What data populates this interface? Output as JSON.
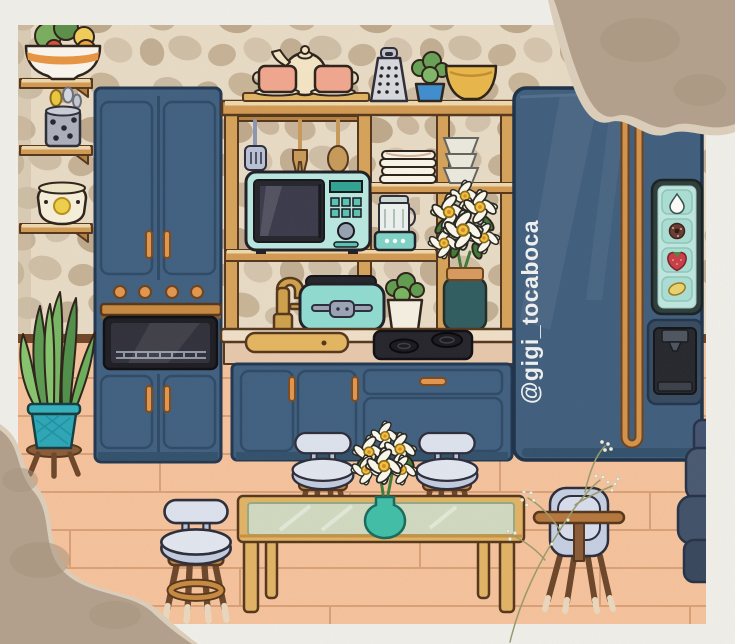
{
  "watermark": {
    "text": "@gigi_tocaboca"
  },
  "fridge": {
    "panel_icons": [
      {
        "name": "water-drop-icon"
      },
      {
        "name": "donut-icon"
      },
      {
        "name": "strawberry-icon"
      },
      {
        "name": "lemon-icon"
      }
    ]
  },
  "scene_items": [
    "fruit-bowl",
    "utensil-crock",
    "slow-cooker",
    "wall-shelves",
    "tall-cabinet",
    "oven",
    "kitchen-hutch",
    "tea-set",
    "grater",
    "potted-plant",
    "yellow-bowl",
    "hanging-utensils",
    "plate-stack",
    "bowl-stack",
    "microwave",
    "blender",
    "daisy-bouquet",
    "faucet",
    "sink",
    "toaster",
    "herb-pot",
    "cooktop",
    "lower-cabinet",
    "refrigerator",
    "fridge-icon-panel",
    "water-dispenser",
    "snake-plant",
    "bar-stool",
    "coffee-table",
    "flower-vase",
    "high-chair",
    "sofa",
    "dried-flowers",
    "torn-paper"
  ],
  "colors": {
    "border_white": "#f1f0ea",
    "wall_base": "#e9dcc6",
    "floor": "#f6c39c",
    "baseboard": "#6f4527",
    "cabinet_blue": "#3f5f80",
    "fridge_blue": "#3e5d7e",
    "accent_copper": "#d3934c",
    "handle_copper": "#e2964e",
    "wood": "#d6a258",
    "counter_top": "#f0e0c8",
    "appliance_teal": "#b9e9e1",
    "toaster_teal": "#8fdcd2",
    "vase_teal": "#3fbfa8",
    "dark_vase": "#2e5b60",
    "cushion_blue": "#c3cde0",
    "cushion_light": "#dde3ef",
    "paper_tear": "#b3a08c",
    "couch_slate": "#47586f"
  }
}
